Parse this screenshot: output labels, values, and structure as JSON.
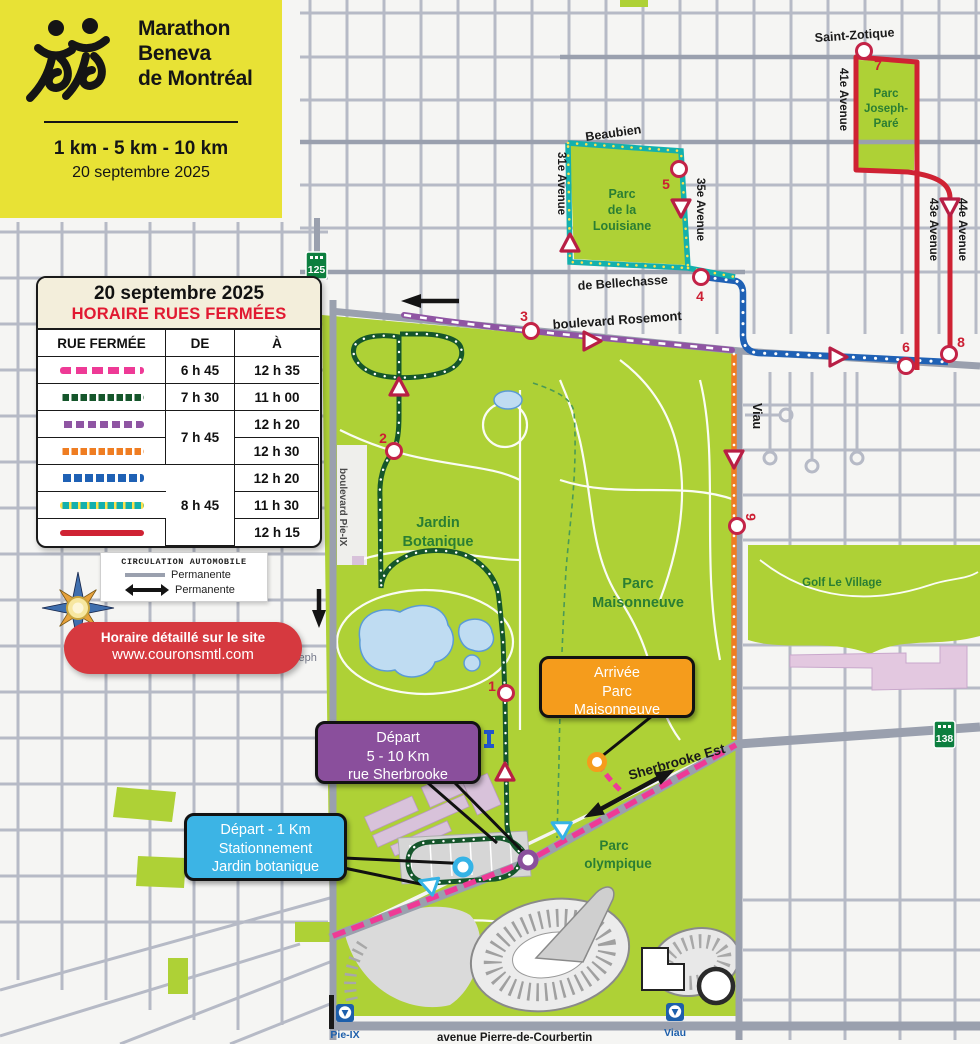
{
  "colors": {
    "brand_yellow": "#e8e235",
    "route_pink": "#ee3a96",
    "route_green_dark": "#15562b",
    "route_purple": "#8f55a3",
    "route_orange": "#ef7d22",
    "route_blue": "#1f61b5",
    "route_teal": "#14b0ad",
    "route_red": "#cf2233",
    "callout_orange": "#f59c1c",
    "callout_purple": "#8a4f9c",
    "callout_blue": "#3cb4e5",
    "banner_red": "#d6393f",
    "park_green": "#aed136",
    "metro_blue": "#1d5fab",
    "shield_green": "#0d7f3f",
    "marker_ring_red": "#c32347"
  },
  "header": {
    "title_lines": [
      "Marathon",
      "Beneva",
      "de Montréal"
    ],
    "distances": "1 km - 5 km - 10 km",
    "date": "20 septembre 2025"
  },
  "schedule": {
    "date": "20 septembre 2025",
    "title": "HORAIRE RUES FERMÉES",
    "columns": {
      "rue": "RUE FERMÉE",
      "de": "DE",
      "a": "À"
    },
    "rows": [
      {
        "route": "sherbrooke-pink",
        "de": "6 h 45",
        "a": "12 h 35"
      },
      {
        "route": "jardin-green",
        "de": "7 h 30",
        "a": "11 h 00"
      },
      {
        "route": "rosemont-ouest-purple",
        "de": "7 h 45",
        "a": "12 h 20"
      },
      {
        "route": "viau-orange",
        "a": "12 h 30"
      },
      {
        "route": "rosemont-est-blue",
        "de": "8 h 45",
        "a": "12 h 20"
      },
      {
        "route": "louisiane-teal",
        "a": "11 h 30"
      },
      {
        "route": "avenues-red",
        "a": "12 h 15"
      }
    ]
  },
  "legend": {
    "title": "CIRCULATION AUTOMOBILE",
    "items": [
      {
        "label": "Permanente"
      },
      {
        "label": "Permanente"
      }
    ]
  },
  "banner": {
    "line1": "Horaire détaillé sur le site",
    "line2": "www.couronsmtl.com"
  },
  "callouts": {
    "arrivee": {
      "lines": [
        "Arrivée",
        "Parc",
        "Maisonneuve"
      ]
    },
    "depart_5_10": {
      "lines": [
        "Départ",
        "5 - 10  Km",
        "rue Sherbrooke"
      ]
    },
    "depart_1km": {
      "lines": [
        "Départ - 1 Km",
        "Stationnement",
        "Jardin botanique"
      ]
    }
  },
  "map": {
    "streets": {
      "saint_zotique": "Saint-Zotique",
      "beaubien": "Beaubien",
      "de_bellechasse": "de Bellechasse",
      "boulevard_rosemont": "boulevard Rosemont",
      "av31": "31e Avenue",
      "av35": "35e Avenue",
      "av41": "41e Avenue",
      "av43": "43e Avenue",
      "av44": "44e Avenue",
      "viau": "Viau",
      "boulevard_pie_ix": "boulevard Pie-IX",
      "sherbrooke_est": "Sherbrooke Est",
      "pierre_de_courbertin": "avenue Pierre-de-Courbertin",
      "saint_joseph_partial": "seph"
    },
    "parks": {
      "joseph_pare": [
        "Parc",
        "Joseph-",
        "Paré"
      ],
      "louisiane": [
        "Parc",
        "de la",
        "Louisiane"
      ],
      "jardin_botanique": [
        "Jardin",
        "Botanique"
      ],
      "maisonneuve": [
        "Parc",
        "Maisonneuve"
      ],
      "golf": "Golf Le Village",
      "olympique": [
        "Parc",
        "olympique"
      ]
    },
    "markers": [
      "1",
      "2",
      "3",
      "4",
      "5",
      "6",
      "7",
      "8",
      "9"
    ],
    "shields": {
      "r125": "125",
      "r138": "138"
    },
    "metro": {
      "pie_ix": "Pie-IX",
      "viau": "Viau"
    }
  }
}
